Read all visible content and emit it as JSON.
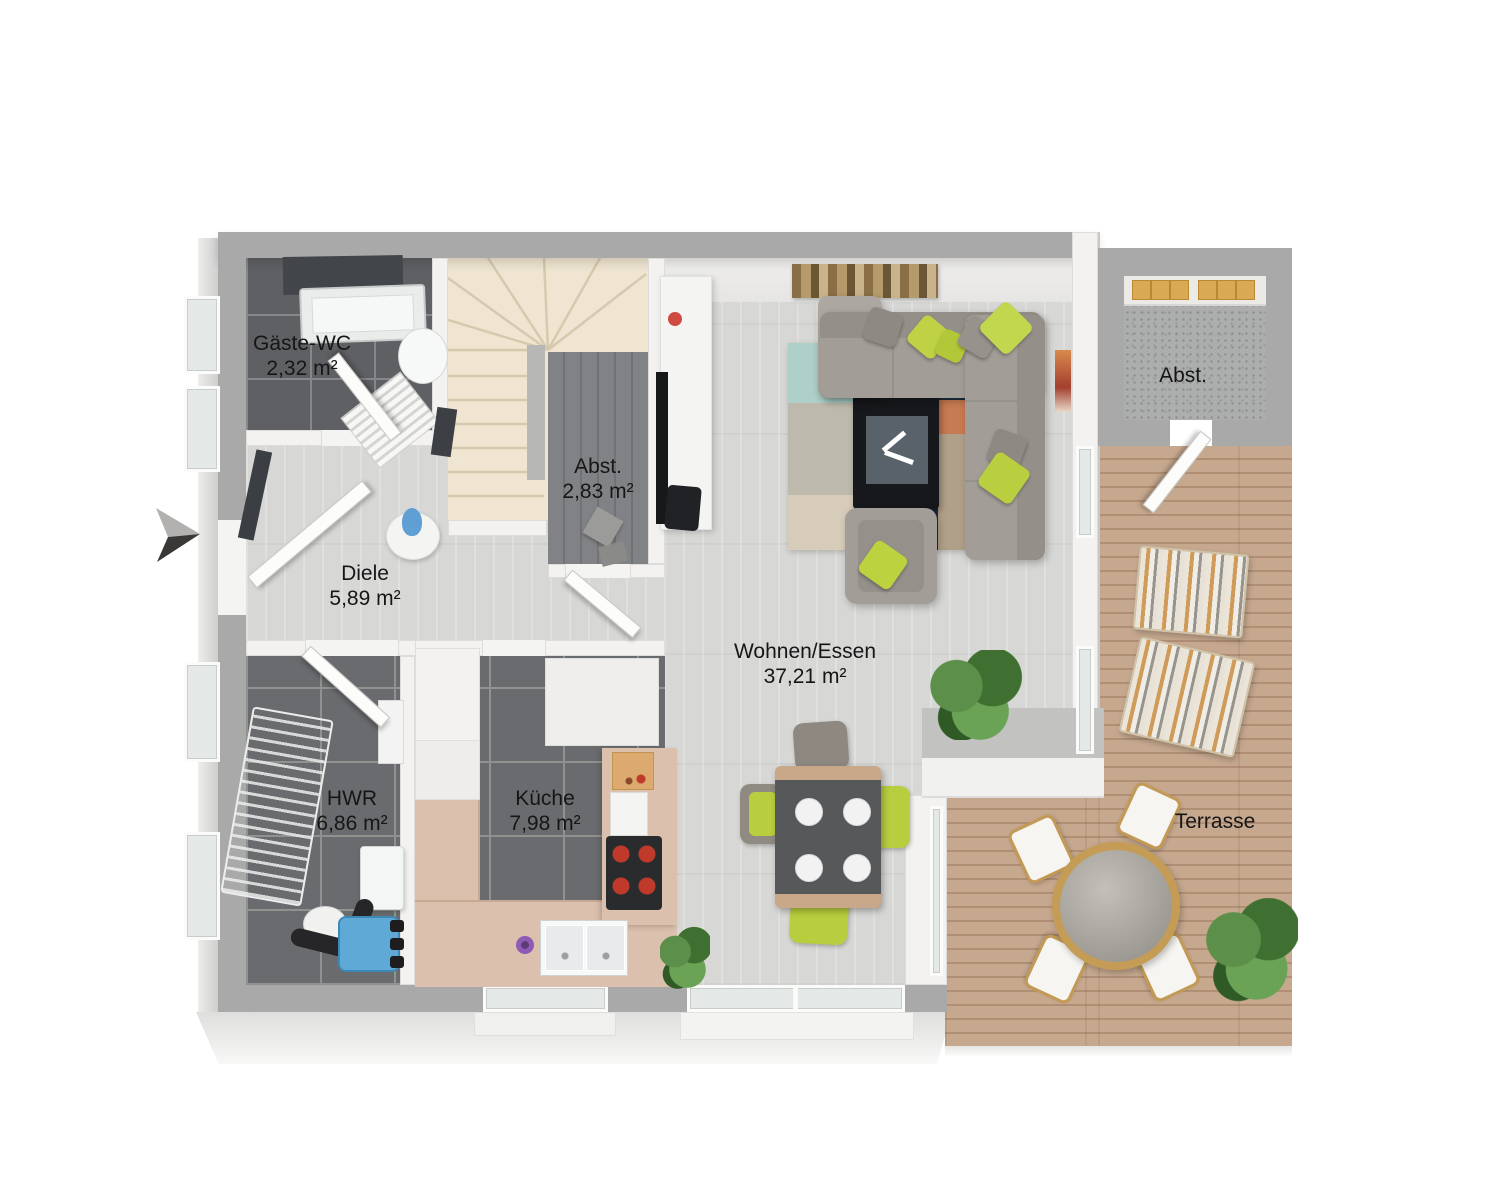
{
  "floorplan": {
    "view": "3d-top-down-floor-plan",
    "language": "de",
    "rooms": [
      {
        "name": "Gäste-WC",
        "area": "2,32 m²"
      },
      {
        "name": "Abst.",
        "area": "2,83 m²"
      },
      {
        "name": "Diele",
        "area": "5,89 m²"
      },
      {
        "name": "HWR",
        "area": "6,86 m²"
      },
      {
        "name": "Küche",
        "area": "7,98 m²"
      },
      {
        "name": "Wohnen/Essen",
        "area": "37,21 m²"
      },
      {
        "name": "Abst.",
        "area": ""
      },
      {
        "name": "Terrasse",
        "area": ""
      }
    ],
    "icons": {
      "orientation_arrow": "double-triangle-right"
    },
    "colors": {
      "exterior_wall": "#a9a9a9",
      "interior_wall": "#f3f2f1",
      "floor_wood_light": "#d7d7d5",
      "floor_tile_dark": "#696b6e",
      "floor_deck": "#c2a188",
      "stairs": "#efe5d1",
      "accent_lime": "#bdd145",
      "sofa_gray": "#a29d97",
      "rug_navy": "#1d2e3f",
      "kitchen_counter": "#dcc0ae",
      "boiler_blue": "#5ea9d6"
    }
  }
}
